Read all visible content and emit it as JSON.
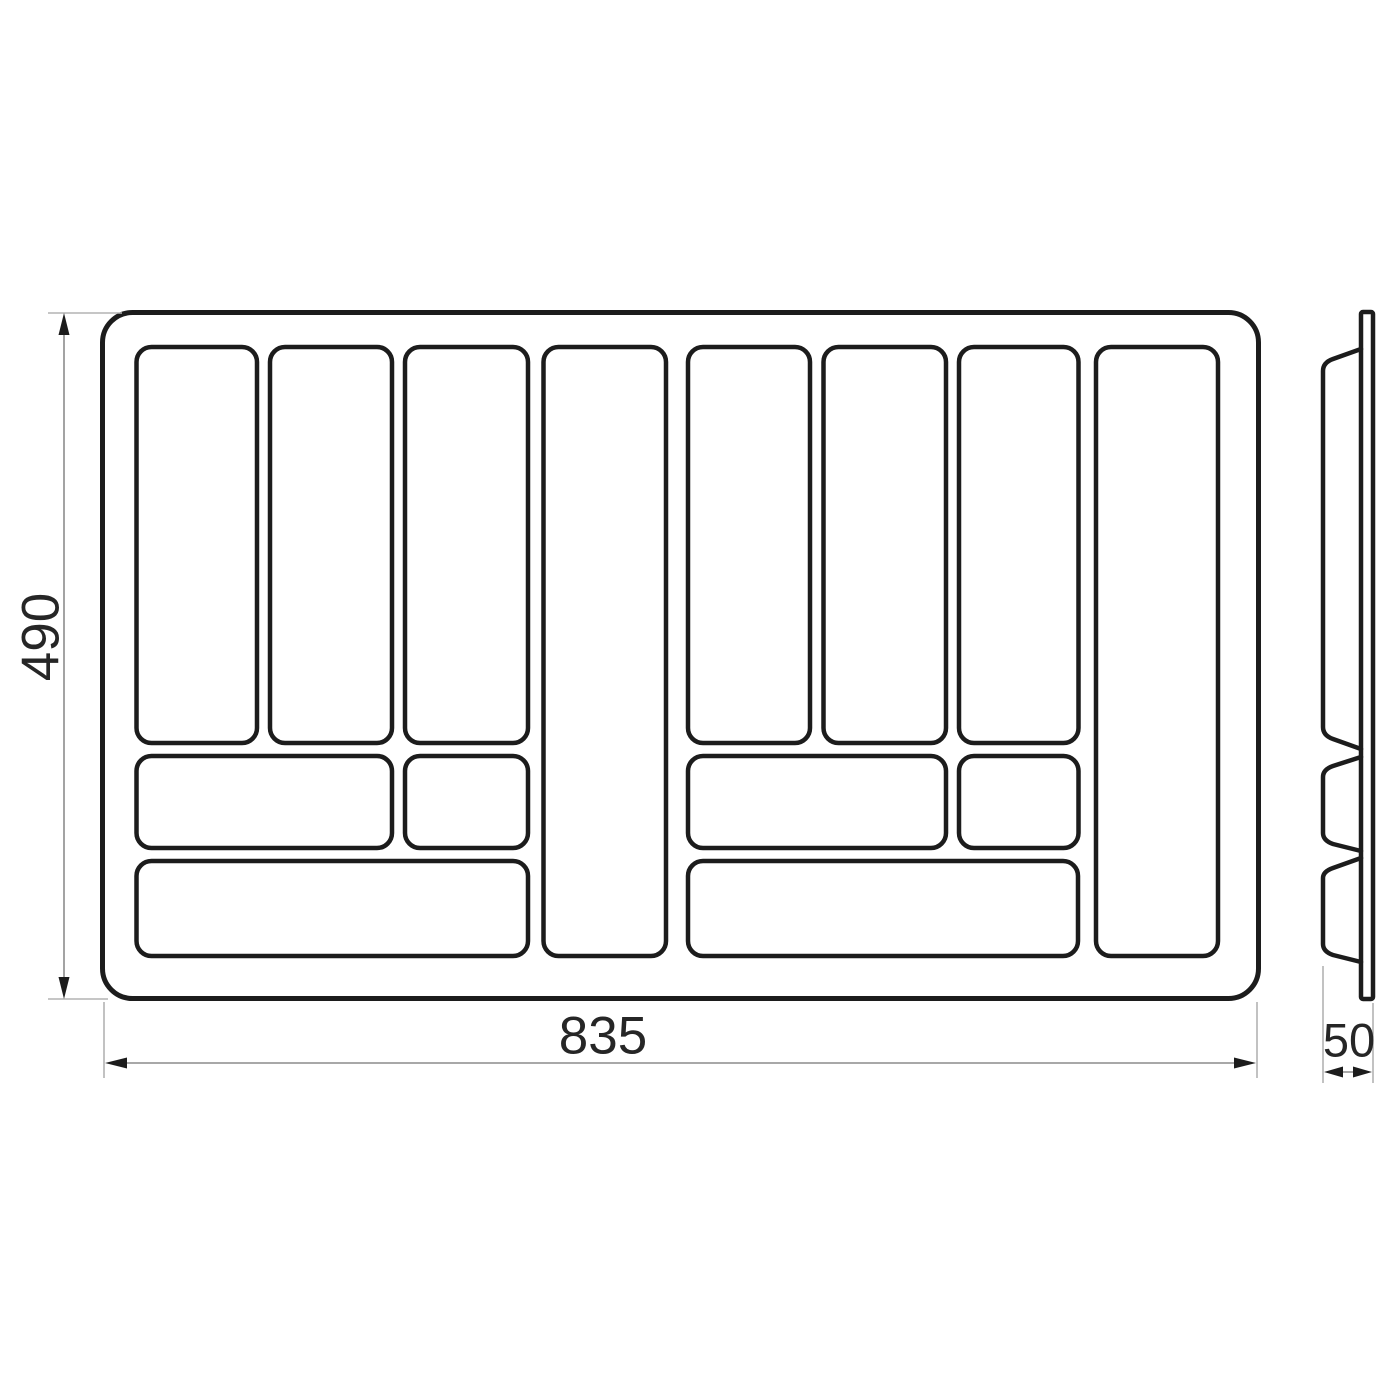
{
  "drawing": {
    "front_view": {
      "name": "cutlery-tray-front-view",
      "height_dim": "490",
      "width_dim": "835",
      "compartment_count": 12
    },
    "side_view": {
      "name": "cutlery-tray-side-profile",
      "depth_dim": "50",
      "bump_count": 3
    }
  },
  "colors": {
    "outline": "#1c1c1c",
    "dimension_line": "#8c8c8c",
    "extension_line": "#b3b3b3",
    "text": "#262626",
    "background": "#ffffff"
  }
}
